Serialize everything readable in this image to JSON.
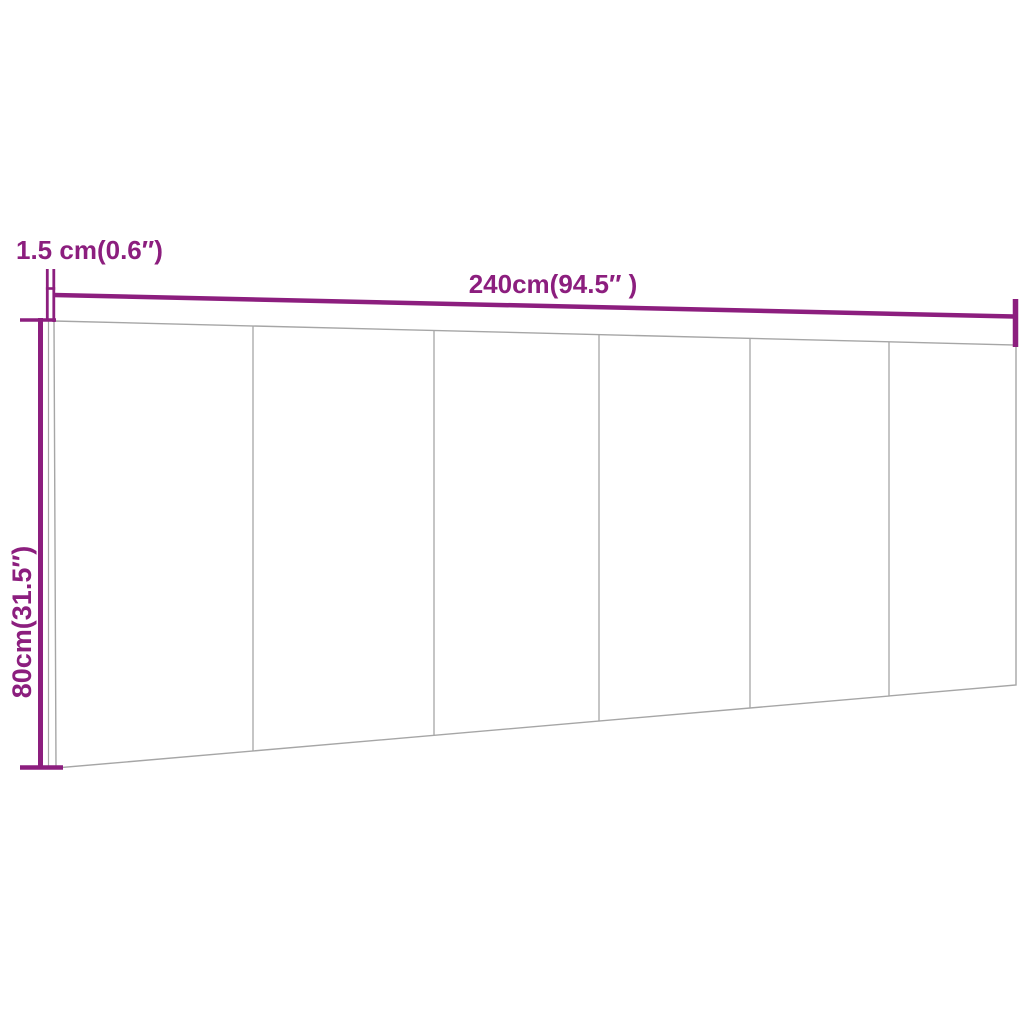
{
  "diagram": {
    "kind": "product-dimension-diagram",
    "labels": {
      "width": "240cm(94.5″ )",
      "height": "80cm(31.5″)",
      "thickness": "1.5 cm(0.6″)"
    },
    "panel_sections": 6,
    "colors": {
      "dimension": "#8c1e7e",
      "panel_line": "#a6a6a6",
      "background": "#ffffff"
    }
  }
}
